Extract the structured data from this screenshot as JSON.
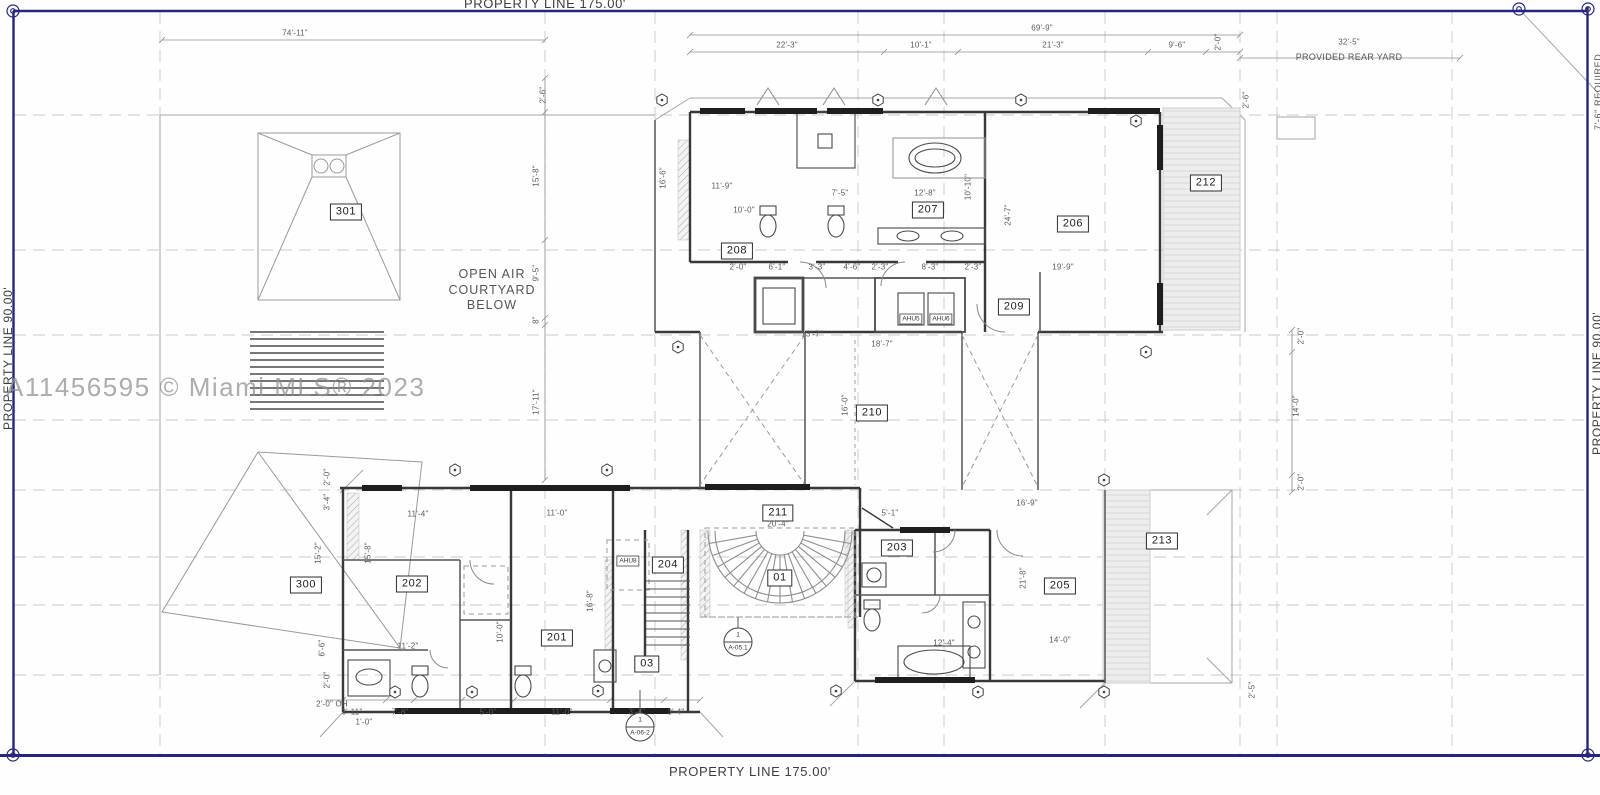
{
  "property": {
    "top_label": "PROPERTY LINE 175.00'",
    "bottom_label": "PROPERTY LINE 175.00'",
    "left_label": "PROPERTY LINE 90.00'",
    "right_label": "PROPERTY LINE 90.00'",
    "rear_yard_note": "PROVIDED REAR YARD",
    "right_setback_note": "7'-6\" REQUIRED"
  },
  "watermark": "A11456595 © Miami MLS® 2023",
  "notes": {
    "courtyard": [
      "OPEN AIR",
      "COURTYARD",
      "BELOW"
    ]
  },
  "rooms": [
    {
      "label": "301",
      "x": 346,
      "y": 212
    },
    {
      "label": "300",
      "x": 306,
      "y": 585
    },
    {
      "label": "202",
      "x": 412,
      "y": 584
    },
    {
      "label": "201",
      "x": 557,
      "y": 638
    },
    {
      "label": "204",
      "x": 668,
      "y": 565
    },
    {
      "label": "03",
      "x": 647,
      "y": 664
    },
    {
      "label": "211",
      "x": 778,
      "y": 513
    },
    {
      "label": "01",
      "x": 780,
      "y": 578
    },
    {
      "label": "203",
      "x": 897,
      "y": 548
    },
    {
      "label": "205",
      "x": 1060,
      "y": 586
    },
    {
      "label": "213",
      "x": 1162,
      "y": 541
    },
    {
      "label": "206",
      "x": 1073,
      "y": 224
    },
    {
      "label": "212",
      "x": 1206,
      "y": 183
    },
    {
      "label": "207",
      "x": 928,
      "y": 210
    },
    {
      "label": "208",
      "x": 737,
      "y": 251
    },
    {
      "label": "209",
      "x": 1014,
      "y": 307
    },
    {
      "label": "210",
      "x": 872,
      "y": 413
    }
  ],
  "equipment": [
    {
      "label": "AHU5",
      "x": 911,
      "y": 319
    },
    {
      "label": "AHU6",
      "x": 941,
      "y": 319
    },
    {
      "label": "AHU8",
      "x": 628,
      "y": 561
    }
  ],
  "section_markers": [
    {
      "top": "1",
      "bottom": "A-05.1",
      "x": 738,
      "y": 642
    },
    {
      "top": "1",
      "bottom": "A-06-2",
      "x": 640,
      "y": 727
    }
  ],
  "dimensions": [
    {
      "t": "74'-11\"",
      "x": 295,
      "y": 33,
      "r": 0
    },
    {
      "t": "69'-9\"",
      "x": 1042,
      "y": 28,
      "r": 0
    },
    {
      "t": "22'-3\"",
      "x": 787,
      "y": 45,
      "r": 0
    },
    {
      "t": "10'-1\"",
      "x": 921,
      "y": 45,
      "r": 0
    },
    {
      "t": "21'-3\"",
      "x": 1053,
      "y": 45,
      "r": 0
    },
    {
      "t": "9'-6\"",
      "x": 1177,
      "y": 45,
      "r": 0
    },
    {
      "t": "2'-0\"",
      "x": 1218,
      "y": 42,
      "r": 1
    },
    {
      "t": "32'-5\"",
      "x": 1349,
      "y": 42,
      "r": 0
    },
    {
      "t": "2'-6\"",
      "x": 543,
      "y": 95,
      "r": 1
    },
    {
      "t": "2'-6\"",
      "x": 1246,
      "y": 100,
      "r": 1
    },
    {
      "t": "15'-8\"",
      "x": 536,
      "y": 176,
      "r": 1
    },
    {
      "t": "9'-5\"",
      "x": 536,
      "y": 273,
      "r": 1
    },
    {
      "t": "8\"",
      "x": 536,
      "y": 320,
      "r": 1
    },
    {
      "t": "17'-11\"",
      "x": 536,
      "y": 402,
      "r": 1
    },
    {
      "t": "16'-6\"",
      "x": 663,
      "y": 178,
      "r": 1
    },
    {
      "t": "2'-0\"",
      "x": 1301,
      "y": 336,
      "r": 1
    },
    {
      "t": "14'-0\"",
      "x": 1296,
      "y": 406,
      "r": 1
    },
    {
      "t": "2'-0\"",
      "x": 1301,
      "y": 482,
      "r": 1
    },
    {
      "t": "2'-5\"",
      "x": 1252,
      "y": 690,
      "r": 1
    },
    {
      "t": "2'-0\" OH",
      "x": 332,
      "y": 704,
      "r": 0
    },
    {
      "t": "3'-11\"",
      "x": 352,
      "y": 712,
      "r": 0
    },
    {
      "t": "7'-8\"",
      "x": 400,
      "y": 712,
      "r": 0
    },
    {
      "t": "5'-0\"",
      "x": 488,
      "y": 712,
      "r": 0
    },
    {
      "t": "11'-0\"",
      "x": 562,
      "y": 712,
      "r": 0
    },
    {
      "t": "3'-4\"",
      "x": 637,
      "y": 712,
      "r": 0
    },
    {
      "t": "3'-4\"",
      "x": 676,
      "y": 712,
      "r": 0
    },
    {
      "t": "1'-0\"",
      "x": 364,
      "y": 722,
      "r": 0
    },
    {
      "t": "11'-9\"",
      "x": 722,
      "y": 186,
      "r": 0
    },
    {
      "t": "7'-5\"",
      "x": 840,
      "y": 193,
      "r": 0
    },
    {
      "t": "12'-8\"",
      "x": 925,
      "y": 193,
      "r": 0
    },
    {
      "t": "10'-0\"",
      "x": 744,
      "y": 210,
      "r": 0
    },
    {
      "t": "10'-10\"",
      "x": 968,
      "y": 187,
      "r": 1
    },
    {
      "t": "13'-7\"",
      "x": 812,
      "y": 334,
      "r": 0
    },
    {
      "t": "18'-7\"",
      "x": 882,
      "y": 344,
      "r": 0
    },
    {
      "t": "16'-0\"",
      "x": 845,
      "y": 405,
      "r": 1
    },
    {
      "t": "19'-9\"",
      "x": 1063,
      "y": 267,
      "r": 0
    },
    {
      "t": "24'-7\"",
      "x": 1008,
      "y": 215,
      "r": 1
    },
    {
      "t": "20'-4\"",
      "x": 778,
      "y": 524,
      "r": 0
    },
    {
      "t": "5'-1\"",
      "x": 890,
      "y": 513,
      "r": 0
    },
    {
      "t": "16'-9\"",
      "x": 1027,
      "y": 503,
      "r": 0
    },
    {
      "t": "21'-8\"",
      "x": 1023,
      "y": 578,
      "r": 1
    },
    {
      "t": "14'-0\"",
      "x": 1060,
      "y": 640,
      "r": 0
    },
    {
      "t": "12'-4\"",
      "x": 944,
      "y": 643,
      "r": 0
    },
    {
      "t": "11'-4\"",
      "x": 418,
      "y": 514,
      "r": 0
    },
    {
      "t": "11'-0\"",
      "x": 557,
      "y": 513,
      "r": 0
    },
    {
      "t": "15'-8\"",
      "x": 368,
      "y": 553,
      "r": 1
    },
    {
      "t": "15'-2\"",
      "x": 318,
      "y": 553,
      "r": 1
    },
    {
      "t": "11'-2\"",
      "x": 408,
      "y": 646,
      "r": 0
    },
    {
      "t": "10'-0\"",
      "x": 500,
      "y": 632,
      "r": 1
    },
    {
      "t": "16'-8\"",
      "x": 590,
      "y": 601,
      "r": 1
    },
    {
      "t": "2'-0\"",
      "x": 327,
      "y": 477,
      "r": 1
    },
    {
      "t": "3'-4\"",
      "x": 327,
      "y": 502,
      "r": 1
    },
    {
      "t": "6'-6\"",
      "x": 322,
      "y": 648,
      "r": 1
    },
    {
      "t": "2'-0\"",
      "x": 327,
      "y": 680,
      "r": 1
    },
    {
      "t": "2'-0\"",
      "x": 738,
      "y": 267,
      "r": 0
    },
    {
      "t": "6'-1\"",
      "x": 777,
      "y": 267,
      "r": 0
    },
    {
      "t": "3'-3\"",
      "x": 817,
      "y": 267,
      "r": 0
    },
    {
      "t": "4'-6\"",
      "x": 852,
      "y": 267,
      "r": 0
    },
    {
      "t": "2'-3\"",
      "x": 880,
      "y": 267,
      "r": 0
    },
    {
      "t": "8'-3\"",
      "x": 930,
      "y": 267,
      "r": 0
    },
    {
      "t": "2'-3\"",
      "x": 973,
      "y": 267,
      "r": 0
    }
  ]
}
